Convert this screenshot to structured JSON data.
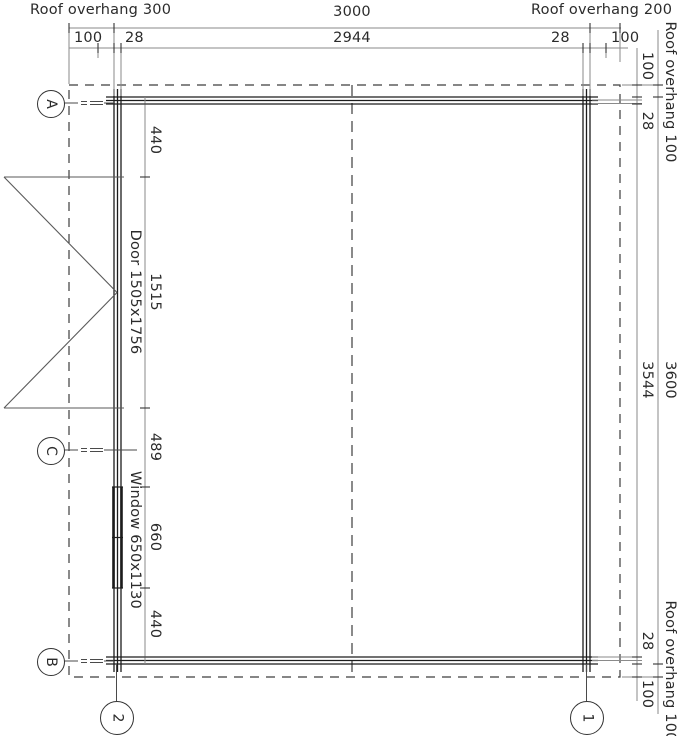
{
  "colors": {
    "wall": "#1c1c1c",
    "dim_line": "#8a8a8a",
    "tick": "#333333",
    "text": "#2b2b2b",
    "dashed": "#3d3d3d",
    "leader": "#4a4a4a",
    "door": "#5a5a5a",
    "background": "#ffffff"
  },
  "dims": {
    "top_outer": {
      "left": "Roof overhang 300",
      "center": "3000",
      "right": "Roof overhang 200"
    },
    "top_inner": {
      "overhang_left": "100",
      "wall_left": "28",
      "span": "2944",
      "wall_right": "28",
      "overhang_right": "100"
    },
    "right_inner": {
      "overhang_top": "100",
      "wall_top": "28",
      "span": "3544",
      "wall_bottom": "28",
      "overhang_bottom": "100"
    },
    "right_outer": {
      "top": "Roof overhang 100",
      "span": "3600",
      "bottom": "Roof overhang 100"
    },
    "interior": {
      "seg_440_top": "440",
      "seg_door": "1515",
      "seg_489": "489",
      "seg_window": "660",
      "seg_440_bottom": "440"
    }
  },
  "annotations": {
    "door": "Door 1505x1756",
    "window": "Window 650x1130"
  },
  "grid": {
    "a": "A",
    "c": "C",
    "b": "B",
    "col2": "2",
    "col1": "1"
  }
}
